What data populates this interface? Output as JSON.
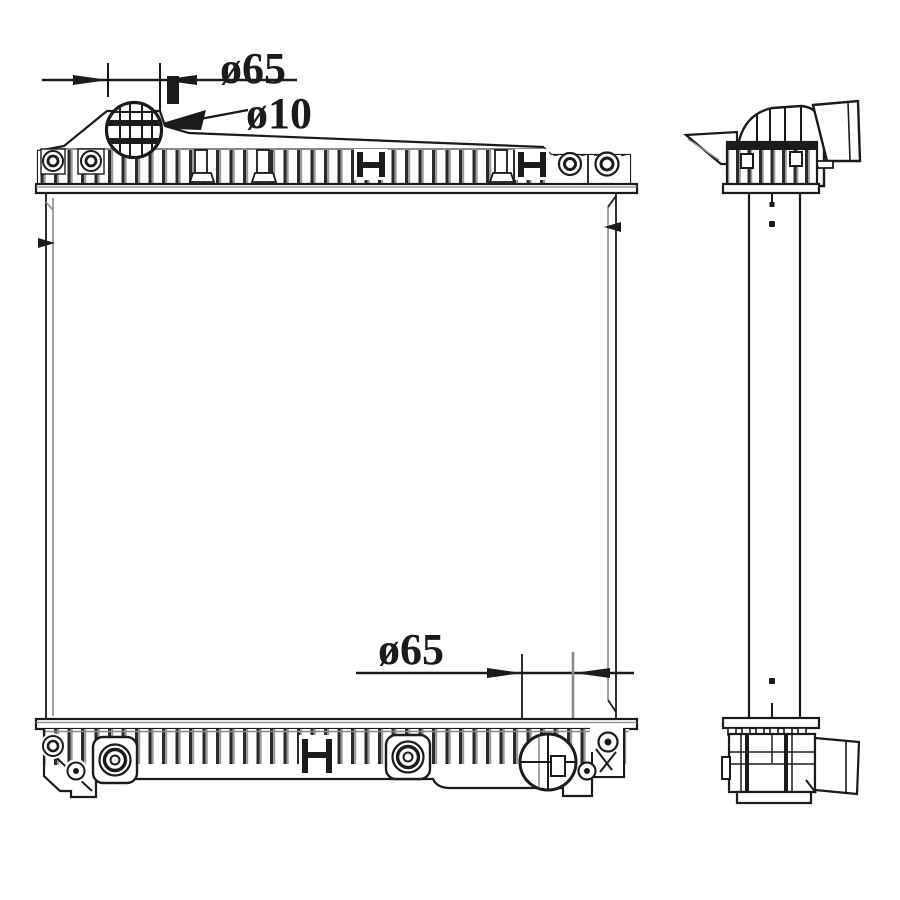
{
  "annotations": {
    "filler_neck_diameter": "ø65",
    "overflow_pipe_diameter": "ø10",
    "outlet_diameter": "ø65"
  },
  "colors": {
    "ink": "#1b1b1b",
    "aux": "#8a8a8a",
    "background": "#ffffff"
  }
}
